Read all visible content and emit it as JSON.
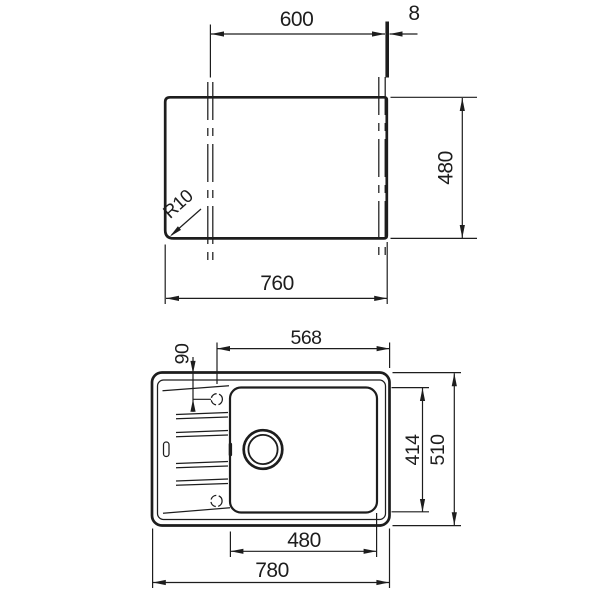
{
  "colors": {
    "ink": "#1d1d1d",
    "background": "#ffffff"
  },
  "cutout_view": {
    "dim_between_cut_marks": "600",
    "dim_edge_thickness": "8",
    "dim_cutout_depth": "480",
    "dim_cutout_width": "760",
    "corner_radius_label": "R10"
  },
  "sink_view": {
    "dim_tap_axis_to_right_edge": "568",
    "dim_tap_hole_offset": "90",
    "dim_bowl_depth": "414",
    "dim_overall_depth": "510",
    "dim_bowl_width": "480",
    "dim_overall_width": "780"
  }
}
